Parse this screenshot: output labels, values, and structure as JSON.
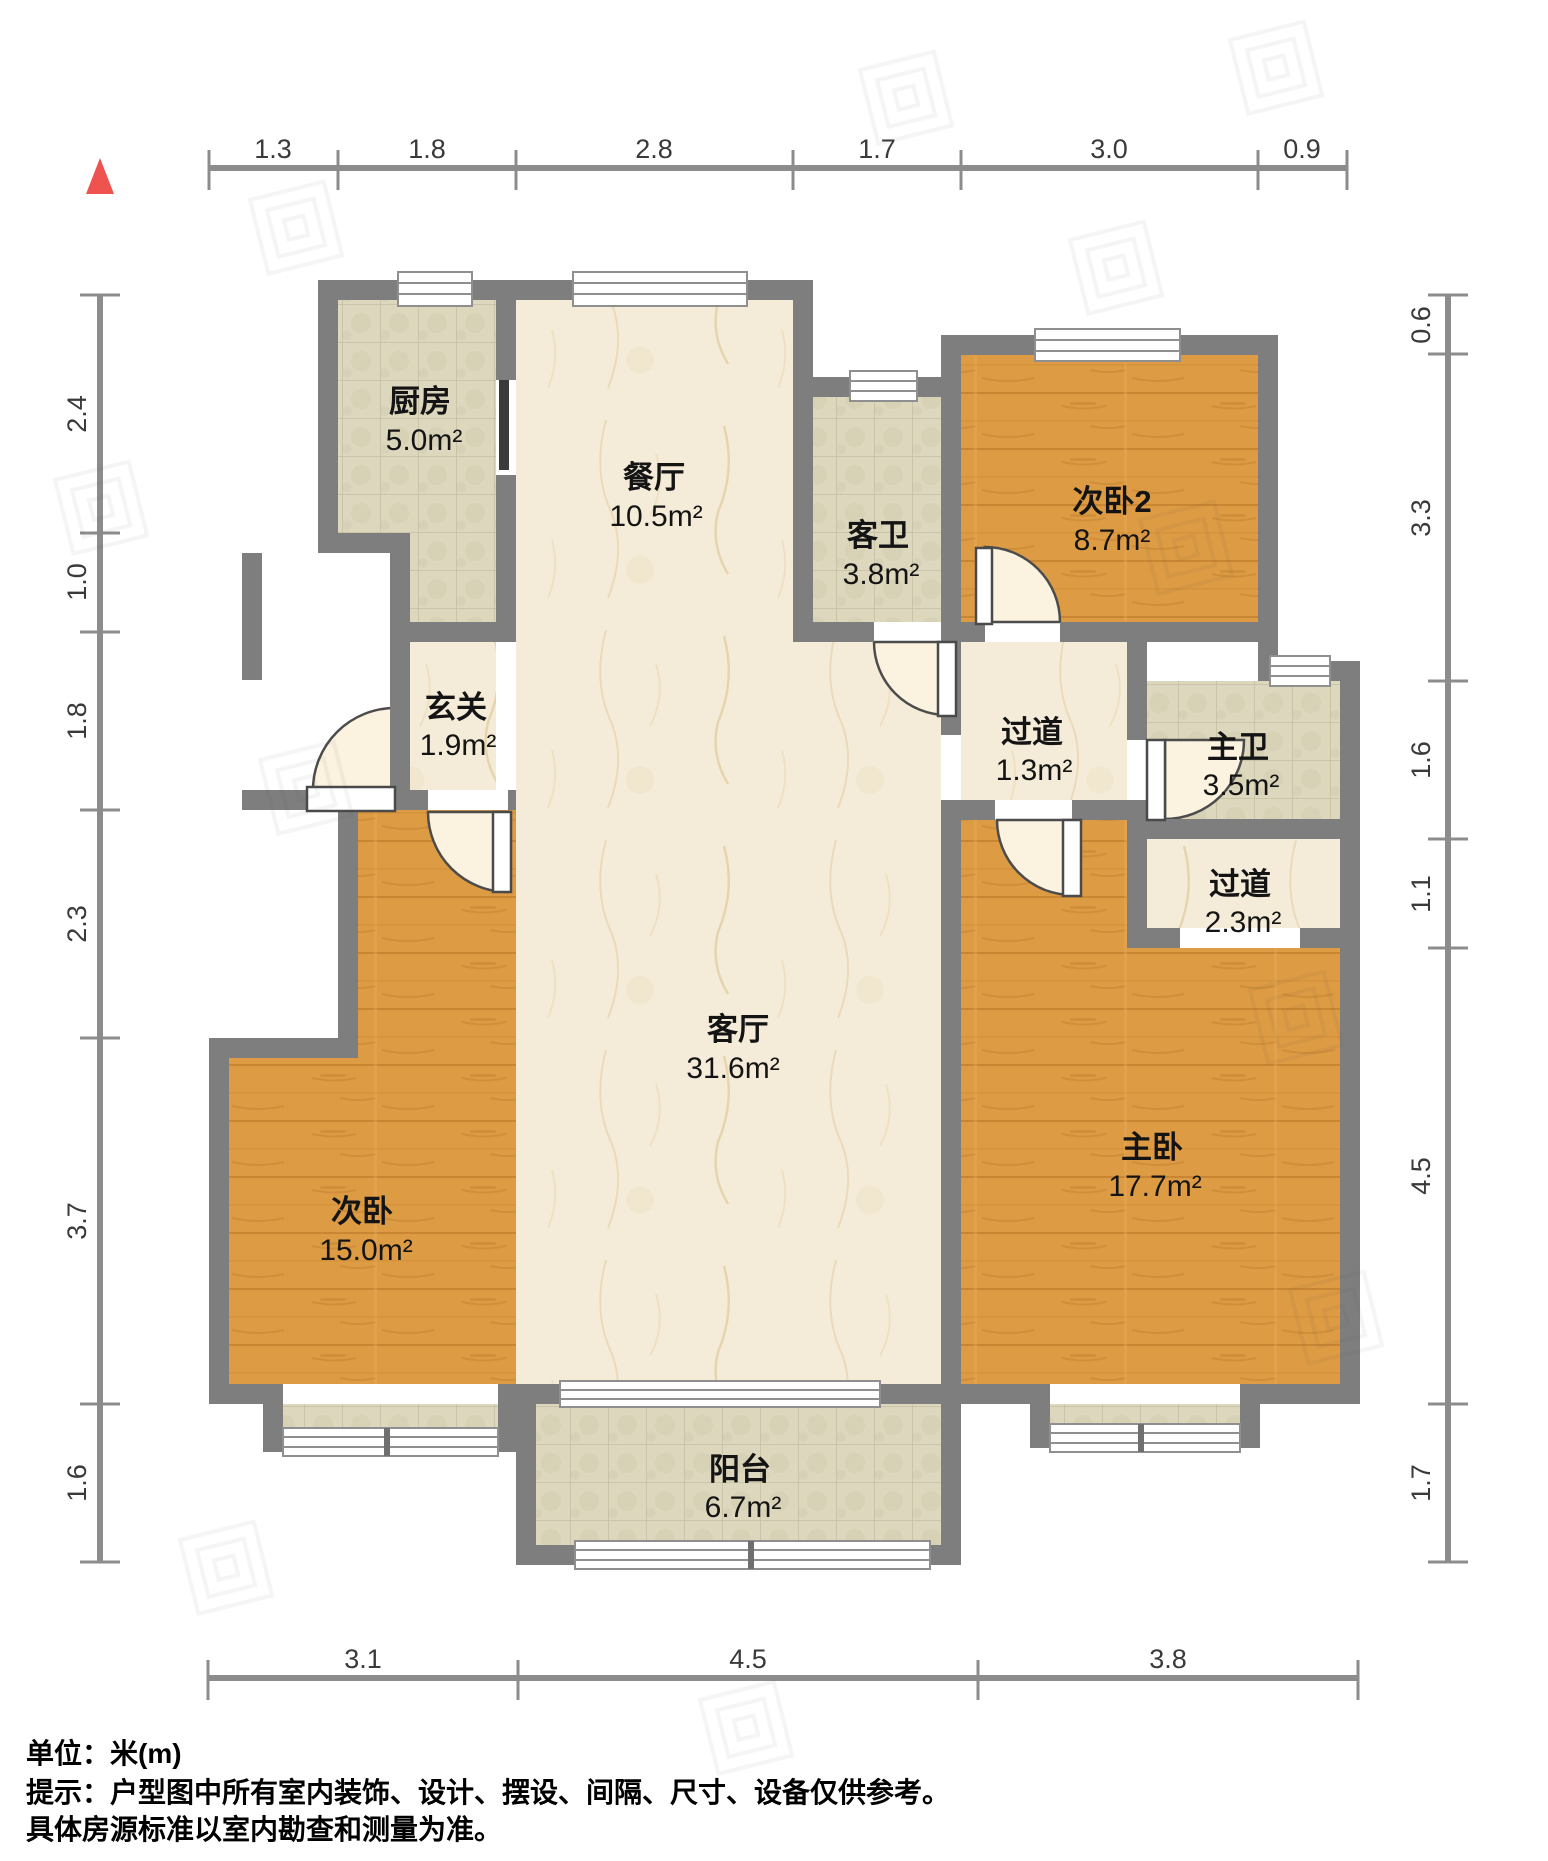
{
  "rooms": {
    "kitchen": {
      "name": "厨房",
      "area": "5.0m²"
    },
    "dining": {
      "name": "餐厅",
      "area": "10.5m²"
    },
    "guest_bath": {
      "name": "客卫",
      "area": "3.8m²"
    },
    "bedroom2": {
      "name": "次卧2",
      "area": "8.7m²"
    },
    "foyer": {
      "name": "玄关",
      "area": "1.9m²"
    },
    "hallway1": {
      "name": "过道",
      "area": "1.3m²"
    },
    "master_bath": {
      "name": "主卫",
      "area": "3.5m²"
    },
    "hallway2": {
      "name": "过道",
      "area": "2.3m²"
    },
    "living": {
      "name": "客厅",
      "area": "31.6m²"
    },
    "bedroom1": {
      "name": "次卧",
      "area": "15.0m²"
    },
    "master_bedroom": {
      "name": "主卧",
      "area": "17.7m²"
    },
    "balcony": {
      "name": "阳台",
      "area": "6.7m²"
    }
  },
  "dimensions": {
    "top": [
      "1.3",
      "1.8",
      "2.8",
      "1.7",
      "3.0",
      "0.9"
    ],
    "left": [
      "2.4",
      "1.0",
      "1.8",
      "2.3",
      "3.7",
      "1.6"
    ],
    "right": [
      "0.6",
      "3.3",
      "1.6",
      "1.1",
      "4.5",
      "1.7"
    ],
    "bottom": [
      "3.1",
      "4.5",
      "3.8"
    ]
  },
  "footer": {
    "unit_line": "单位：米(m)",
    "note_line1": "提示：户型图中所有室内装饰、设计、摆设、间隔、尺寸、设备仅供参考。",
    "note_line2": "具体房源标准以室内勘查和测量为准。"
  },
  "colors": {
    "wall": "#7e7e7e",
    "wood_floor": "#dd9b44",
    "tile_floor": "#dcd7bd",
    "marble_floor": "#f4ecd9",
    "north_arrow": "#ef5350",
    "dimension_line": "#8c8c8c"
  }
}
